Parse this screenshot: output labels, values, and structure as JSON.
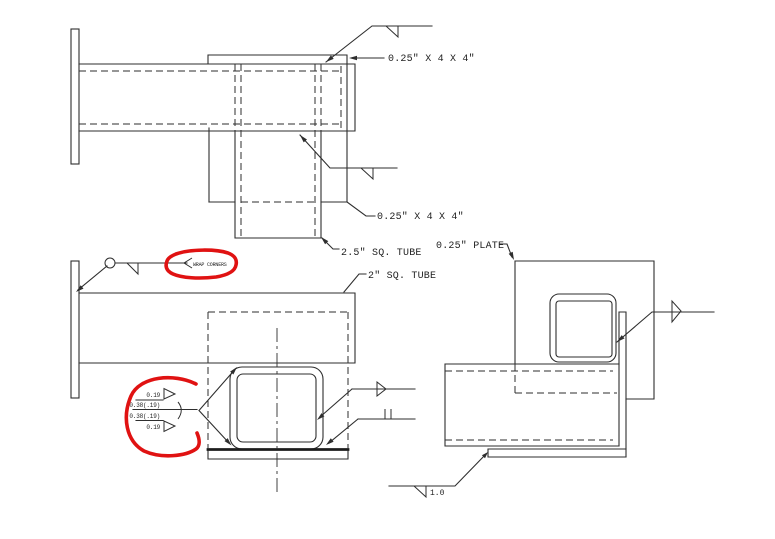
{
  "drawing": {
    "type": "weldment-detail-cad-drawing",
    "labels": {
      "plate_4x4_top": "0.25\" X 4 X 4\"",
      "plate_4x4_mid": "0.25\" X 4 X 4\"",
      "sq_tube_25": "2.5\" SQ. TUBE",
      "sq_tube_2": "2\" SQ. TUBE",
      "plate_025": "0.25\" PLATE",
      "wrap_corners_note": "WRAP CORNERS",
      "weld_size_bottom": "1.0"
    },
    "weld_stack": {
      "top_fillet_size": "0.19",
      "top_groove_size": "0.38(.19)",
      "bottom_groove_size": "0.38(.19)",
      "bottom_fillet_size": "0.19"
    },
    "colors": {
      "line": "#2e2e2e",
      "markup_red": "#e01212",
      "background": "#ffffff"
    }
  }
}
